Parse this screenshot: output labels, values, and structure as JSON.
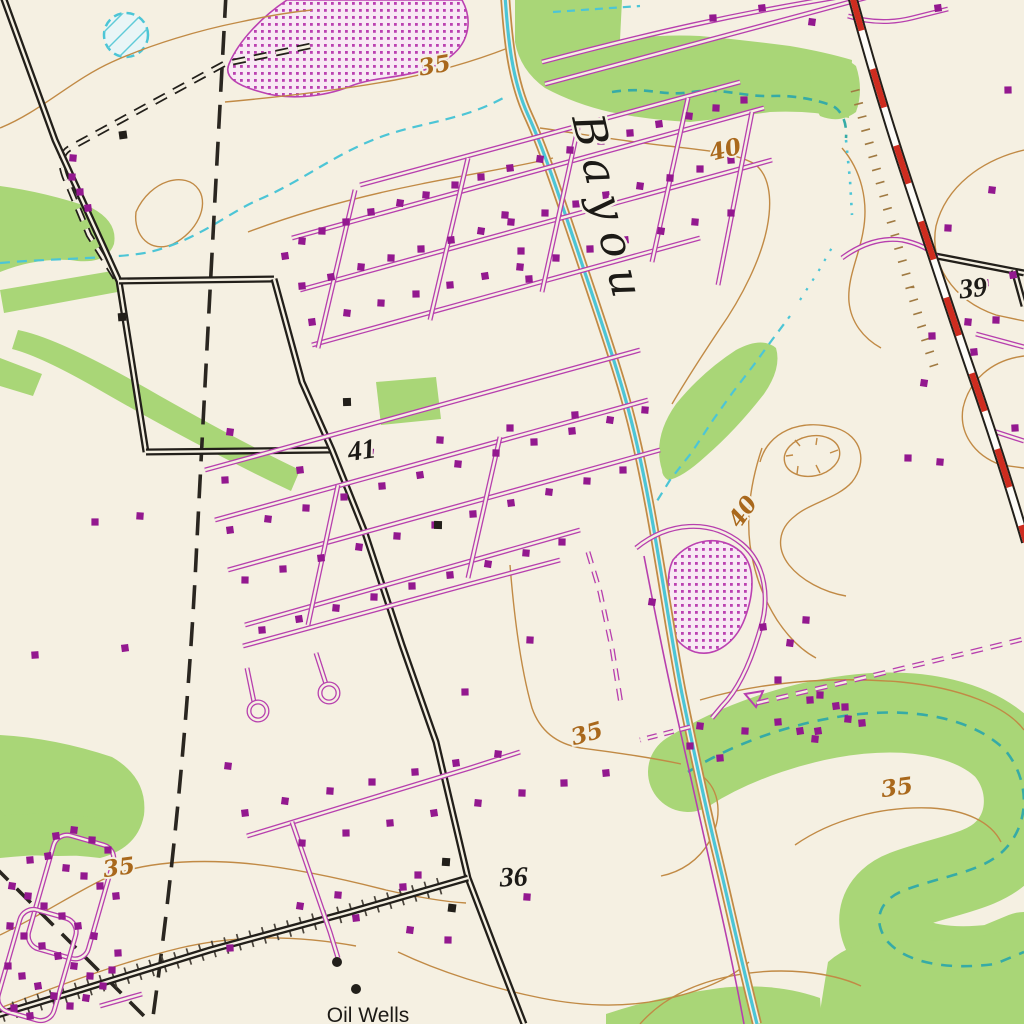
{
  "map": {
    "description": "USGS topographic map section showing a bayou, subdivisions, oil wells and highway",
    "colors": {
      "paper": "#f5f0e2",
      "vegetation_green": "#a9d677",
      "contour_orange": "#c18a45",
      "contour_label": "#a9681c",
      "water_cyan": "#4cc5d6",
      "water_teal": "#36aba6",
      "road_purple": "#b73fae",
      "building_purple": "#93188f",
      "stipple_dot": "#bb41b1",
      "stipple_bg": "#f8e9f4",
      "ink_black": "#221f1a",
      "highway_red": "#ce2c1f",
      "boundary_black": "#2a2620",
      "tick_dark": "#4a443b",
      "tick_tan": "#a07a42"
    },
    "labels": [
      {
        "text": "Bayou",
        "x": 572,
        "y": 118,
        "rot": 77,
        "size": 44,
        "style": "bayou",
        "color": "#1c1a16",
        "name": "bayou-label"
      },
      {
        "text": "35",
        "x": 436,
        "y": 73,
        "rot": -10,
        "size": 23,
        "style": "contour",
        "color": "#a9681c",
        "name": "contour-label-35-top"
      },
      {
        "text": "40",
        "x": 727,
        "y": 157,
        "rot": -14,
        "size": 23,
        "style": "contour",
        "color": "#a9681c",
        "name": "contour-label-40-upper"
      },
      {
        "text": "39",
        "x": 974,
        "y": 297,
        "rot": -6,
        "size": 30,
        "style": "spot",
        "color": "#1c1a16",
        "name": "spot-elevation-39"
      },
      {
        "text": "41",
        "x": 363,
        "y": 459,
        "rot": -8,
        "size": 27,
        "style": "spot",
        "color": "#1c1a16",
        "name": "spot-elevation-41"
      },
      {
        "text": "40",
        "x": 749,
        "y": 516,
        "rot": -55,
        "size": 23,
        "style": "contour",
        "color": "#a9681c",
        "name": "contour-label-40-mid"
      },
      {
        "text": "35",
        "x": 589,
        "y": 741,
        "rot": -16,
        "size": 23,
        "style": "contour",
        "color": "#a9681c",
        "name": "contour-label-35-mid"
      },
      {
        "text": "35",
        "x": 898,
        "y": 795,
        "rot": -8,
        "size": 23,
        "style": "contour",
        "color": "#a9681c",
        "name": "contour-label-35-right"
      },
      {
        "text": "35",
        "x": 120,
        "y": 875,
        "rot": -8,
        "size": 25,
        "style": "contour",
        "color": "#a9681c",
        "name": "contour-label-35-left"
      },
      {
        "text": "36",
        "x": 514,
        "y": 886,
        "rot": -2,
        "size": 30,
        "style": "spot",
        "color": "#1c1a16",
        "name": "spot-elevation-36"
      },
      {
        "text": "Oil Wells",
        "x": 368,
        "y": 1022,
        "rot": 0,
        "size": 21,
        "style": "feature",
        "color": "#1c1a16",
        "name": "oil-wells-label"
      }
    ],
    "oil_wells": {
      "dots": [
        [
          337,
          962
        ],
        [
          356,
          989
        ]
      ]
    },
    "buildings_black": [
      [
        123,
        135
      ],
      [
        122,
        317
      ],
      [
        347,
        402
      ],
      [
        438,
        525
      ],
      [
        446,
        862
      ],
      [
        452,
        908
      ]
    ],
    "buildings_purple": [
      [
        285,
        256
      ],
      [
        302,
        241
      ],
      [
        322,
        231
      ],
      [
        346,
        222
      ],
      [
        371,
        212
      ],
      [
        400,
        203
      ],
      [
        426,
        195
      ],
      [
        455,
        185
      ],
      [
        481,
        177
      ],
      [
        510,
        168
      ],
      [
        540,
        159
      ],
      [
        570,
        150
      ],
      [
        601,
        141
      ],
      [
        630,
        133
      ],
      [
        659,
        124
      ],
      [
        689,
        116
      ],
      [
        716,
        108
      ],
      [
        744,
        100
      ],
      [
        302,
        286
      ],
      [
        331,
        277
      ],
      [
        361,
        267
      ],
      [
        391,
        258
      ],
      [
        421,
        249
      ],
      [
        451,
        240
      ],
      [
        481,
        231
      ],
      [
        511,
        222
      ],
      [
        545,
        213
      ],
      [
        576,
        204
      ],
      [
        606,
        195
      ],
      [
        640,
        186
      ],
      [
        670,
        178
      ],
      [
        700,
        169
      ],
      [
        731,
        160
      ],
      [
        312,
        322
      ],
      [
        347,
        313
      ],
      [
        381,
        303
      ],
      [
        416,
        294
      ],
      [
        450,
        285
      ],
      [
        485,
        276
      ],
      [
        520,
        267
      ],
      [
        556,
        258
      ],
      [
        590,
        249
      ],
      [
        625,
        240
      ],
      [
        661,
        231
      ],
      [
        695,
        222
      ],
      [
        731,
        213
      ],
      [
        713,
        18
      ],
      [
        762,
        8
      ],
      [
        812,
        22
      ],
      [
        505,
        215
      ],
      [
        521,
        251
      ],
      [
        529,
        279
      ],
      [
        230,
        530
      ],
      [
        268,
        519
      ],
      [
        306,
        508
      ],
      [
        344,
        497
      ],
      [
        382,
        486
      ],
      [
        420,
        475
      ],
      [
        458,
        464
      ],
      [
        496,
        453
      ],
      [
        534,
        442
      ],
      [
        572,
        431
      ],
      [
        610,
        420
      ],
      [
        645,
        410
      ],
      [
        245,
        580
      ],
      [
        283,
        569
      ],
      [
        321,
        558
      ],
      [
        359,
        547
      ],
      [
        397,
        536
      ],
      [
        435,
        525
      ],
      [
        473,
        514
      ],
      [
        511,
        503
      ],
      [
        549,
        492
      ],
      [
        587,
        481
      ],
      [
        623,
        470
      ],
      [
        262,
        630
      ],
      [
        299,
        619
      ],
      [
        336,
        608
      ],
      [
        374,
        597
      ],
      [
        412,
        586
      ],
      [
        450,
        575
      ],
      [
        488,
        564
      ],
      [
        526,
        553
      ],
      [
        562,
        542
      ],
      [
        225,
        480
      ],
      [
        300,
        470
      ],
      [
        370,
        452
      ],
      [
        440,
        440
      ],
      [
        510,
        428
      ],
      [
        575,
        415
      ],
      [
        56,
        836
      ],
      [
        74,
        830
      ],
      [
        92,
        840
      ],
      [
        108,
        850
      ],
      [
        30,
        860
      ],
      [
        48,
        856
      ],
      [
        66,
        868
      ],
      [
        84,
        876
      ],
      [
        100,
        886
      ],
      [
        116,
        896
      ],
      [
        12,
        886
      ],
      [
        28,
        896
      ],
      [
        44,
        906
      ],
      [
        62,
        916
      ],
      [
        78,
        926
      ],
      [
        94,
        936
      ],
      [
        10,
        926
      ],
      [
        24,
        936
      ],
      [
        42,
        946
      ],
      [
        58,
        956
      ],
      [
        74,
        966
      ],
      [
        90,
        976
      ],
      [
        8,
        966
      ],
      [
        22,
        976
      ],
      [
        38,
        986
      ],
      [
        54,
        996
      ],
      [
        70,
        1006
      ],
      [
        14,
        1008
      ],
      [
        30,
        1016
      ],
      [
        86,
        998
      ],
      [
        103,
        986
      ],
      [
        112,
        970
      ],
      [
        118,
        953
      ],
      [
        245,
        813
      ],
      [
        285,
        801
      ],
      [
        330,
        791
      ],
      [
        372,
        782
      ],
      [
        415,
        772
      ],
      [
        456,
        763
      ],
      [
        498,
        754
      ],
      [
        302,
        843
      ],
      [
        346,
        833
      ],
      [
        390,
        823
      ],
      [
        434,
        813
      ],
      [
        478,
        803
      ],
      [
        522,
        793
      ],
      [
        564,
        783
      ],
      [
        606,
        773
      ],
      [
        300,
        906
      ],
      [
        338,
        895
      ],
      [
        448,
        940
      ],
      [
        230,
        948
      ],
      [
        356,
        918
      ],
      [
        410,
        930
      ],
      [
        527,
        897
      ],
      [
        418,
        875
      ],
      [
        403,
        887
      ],
      [
        938,
        8
      ],
      [
        992,
        190
      ],
      [
        948,
        228
      ],
      [
        1008,
        90
      ],
      [
        985,
        283
      ],
      [
        1013,
        275
      ],
      [
        968,
        322
      ],
      [
        996,
        320
      ],
      [
        932,
        336
      ],
      [
        974,
        352
      ],
      [
        924,
        383
      ],
      [
        940,
        462
      ],
      [
        908,
        458
      ],
      [
        1015,
        428
      ],
      [
        763,
        627
      ],
      [
        790,
        643
      ],
      [
        806,
        620
      ],
      [
        778,
        680
      ],
      [
        810,
        700
      ],
      [
        836,
        706
      ],
      [
        700,
        726
      ],
      [
        745,
        731
      ],
      [
        690,
        746
      ],
      [
        720,
        758
      ],
      [
        818,
        731
      ],
      [
        848,
        719
      ],
      [
        820,
        695
      ],
      [
        845,
        707
      ],
      [
        862,
        723
      ],
      [
        652,
        602
      ],
      [
        73,
        158
      ],
      [
        72,
        177
      ],
      [
        80,
        192
      ],
      [
        88,
        208
      ],
      [
        230,
        432
      ],
      [
        140,
        516
      ],
      [
        95,
        522
      ],
      [
        35,
        655
      ],
      [
        125,
        648
      ],
      [
        228,
        766
      ],
      [
        530,
        640
      ],
      [
        465,
        692
      ],
      [
        778,
        722
      ],
      [
        800,
        731
      ],
      [
        815,
        739
      ]
    ]
  }
}
